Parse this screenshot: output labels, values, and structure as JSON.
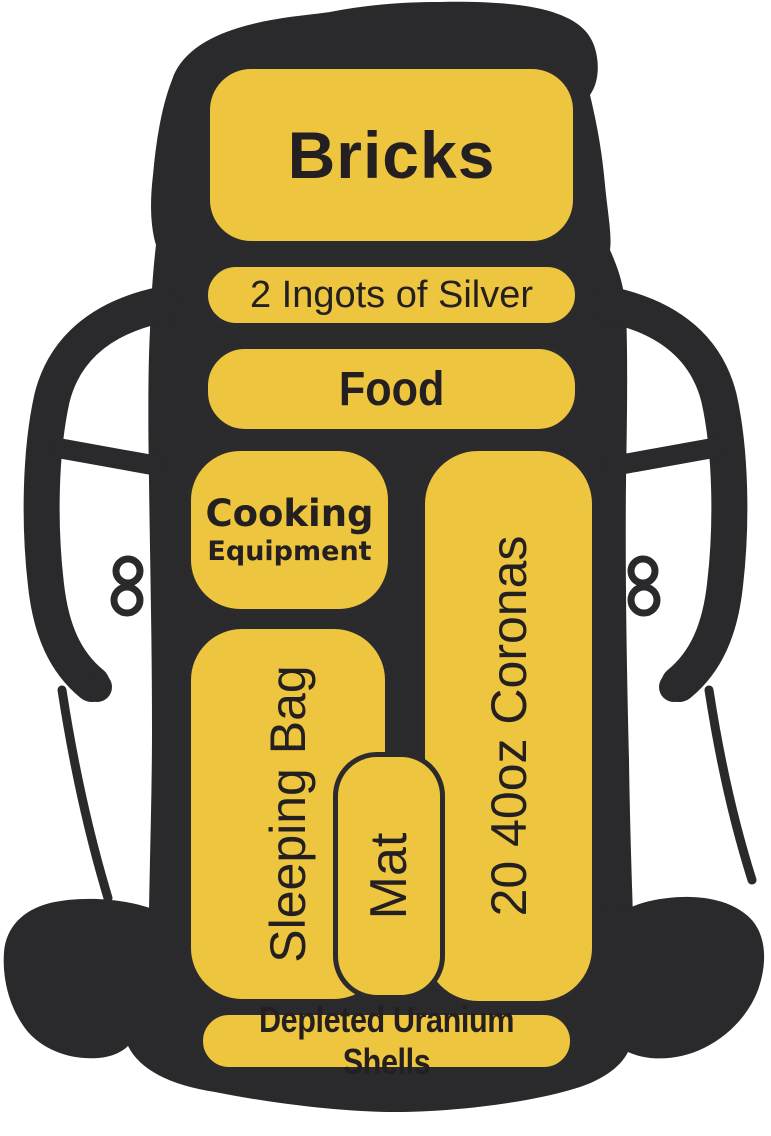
{
  "figure": {
    "type": "backpack-packing-diagram",
    "background_color": "#ffffff",
    "silhouette_color": "#2a2a2c",
    "compartment_fill": "#edc53e",
    "compartment_border": "#2b2b2d",
    "text_color": "#241f20"
  },
  "compartments": {
    "bricks": {
      "label": "Bricks",
      "orientation": "horizontal"
    },
    "silver": {
      "label": "2 Ingots of Silver",
      "orientation": "horizontal"
    },
    "food": {
      "label": "Food",
      "orientation": "horizontal"
    },
    "cooking": {
      "label_line1": "Cooking",
      "label_line2": "Equipment",
      "orientation": "horizontal"
    },
    "coronas": {
      "label": "20 40oz Coronas",
      "orientation": "vertical"
    },
    "sleeping_bag": {
      "label": "Sleeping Bag",
      "orientation": "vertical"
    },
    "mat": {
      "label": "Mat",
      "orientation": "vertical"
    },
    "uranium": {
      "label": "Depleted Uranium Shells",
      "orientation": "horizontal"
    }
  }
}
